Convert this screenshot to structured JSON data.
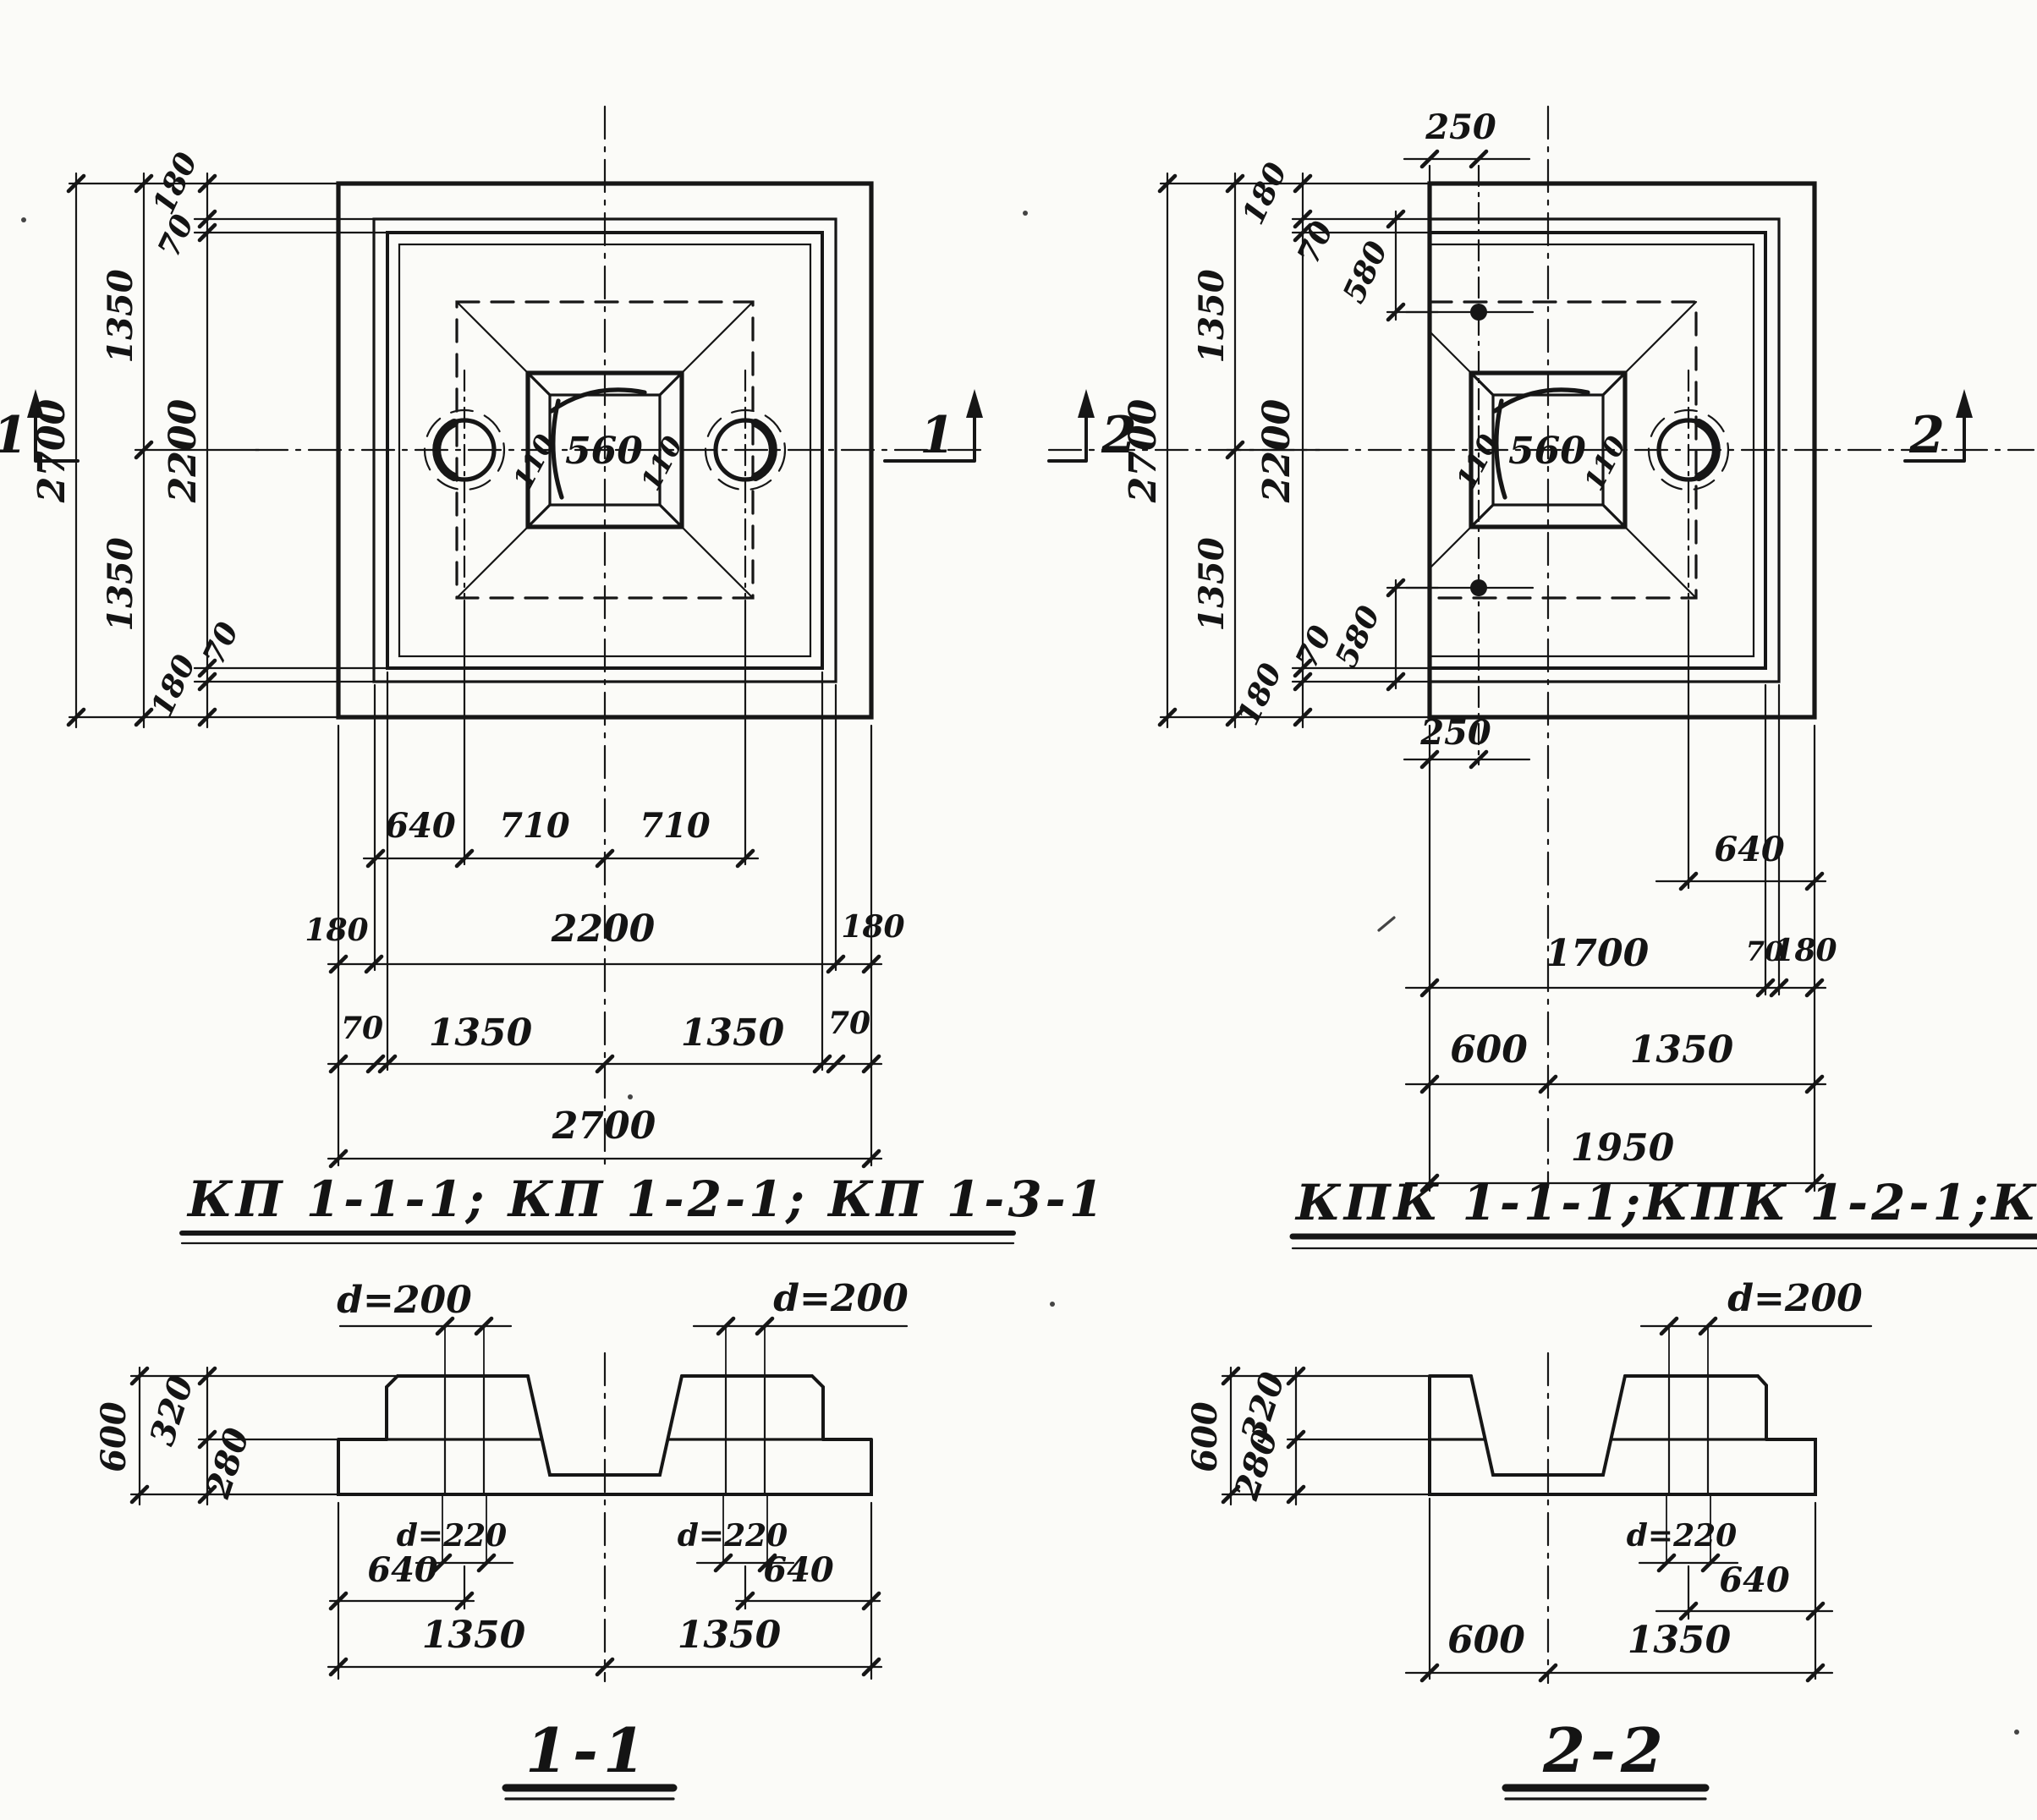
{
  "titles": {
    "left": "КП 1-1-1; КП 1-2-1; КП 1-3-1",
    "right": "КПК 1-1-1;КПК 1-2-1;КПК 1-3-1"
  },
  "plan_left": {
    "total_height": "2700",
    "half_top": "1350",
    "half_bottom": "1350",
    "wall_top": "180",
    "gap_top": "70",
    "inner_height": "2200",
    "gap_bottom": "70",
    "wall_bottom": "180",
    "socket_wall_left": "110",
    "socket": "560",
    "socket_wall_right": "110",
    "hole_offset": "640",
    "hole_to_center_a": "710",
    "hole_to_center_b": "710",
    "wall_left": "180",
    "inner_width": "2200",
    "wall_right": "180",
    "gap_left": "70",
    "half_left": "1350",
    "half_right": "1350",
    "gap_right": "70",
    "total_width": "2700",
    "mark_left": "1",
    "mark_right": "1"
  },
  "plan_right": {
    "top_offset": "250",
    "total_height": "2700",
    "half_top": "1350",
    "half_bottom": "1350",
    "wall_top": "180",
    "gap_top": "70",
    "anchor_top": "580",
    "inner_height": "2200",
    "gap_bottom": "70",
    "anchor_bottom": "580",
    "wall_bottom": "180",
    "socket_wall_left": "110",
    "socket": "560",
    "socket_wall_right": "110",
    "bottom_offset": "250",
    "hole_offset": "640",
    "body_width": "1700",
    "gap_right": "70",
    "wall_right": "180",
    "cut_width": "600",
    "half_width": "1350",
    "total_width": "1950",
    "mark_left": "2",
    "mark_right": "2"
  },
  "section_1": {
    "label": "1-1",
    "hole_dia_left": "d=200",
    "hole_dia_right": "d=200",
    "height": "600",
    "top_height": "320",
    "slab_height": "280",
    "bottom_dia_left": "d=220",
    "bottom_dia_right": "d=220",
    "hole_off_left": "640",
    "hole_off_right": "640",
    "half_left": "1350",
    "half_right": "1350"
  },
  "section_2": {
    "label": "2-2",
    "hole_dia": "d=200",
    "height": "600",
    "top_height": "320",
    "slab_height": "280",
    "bottom_dia": "d=220",
    "hole_off": "640",
    "cut_width": "600",
    "half_width": "1350"
  }
}
